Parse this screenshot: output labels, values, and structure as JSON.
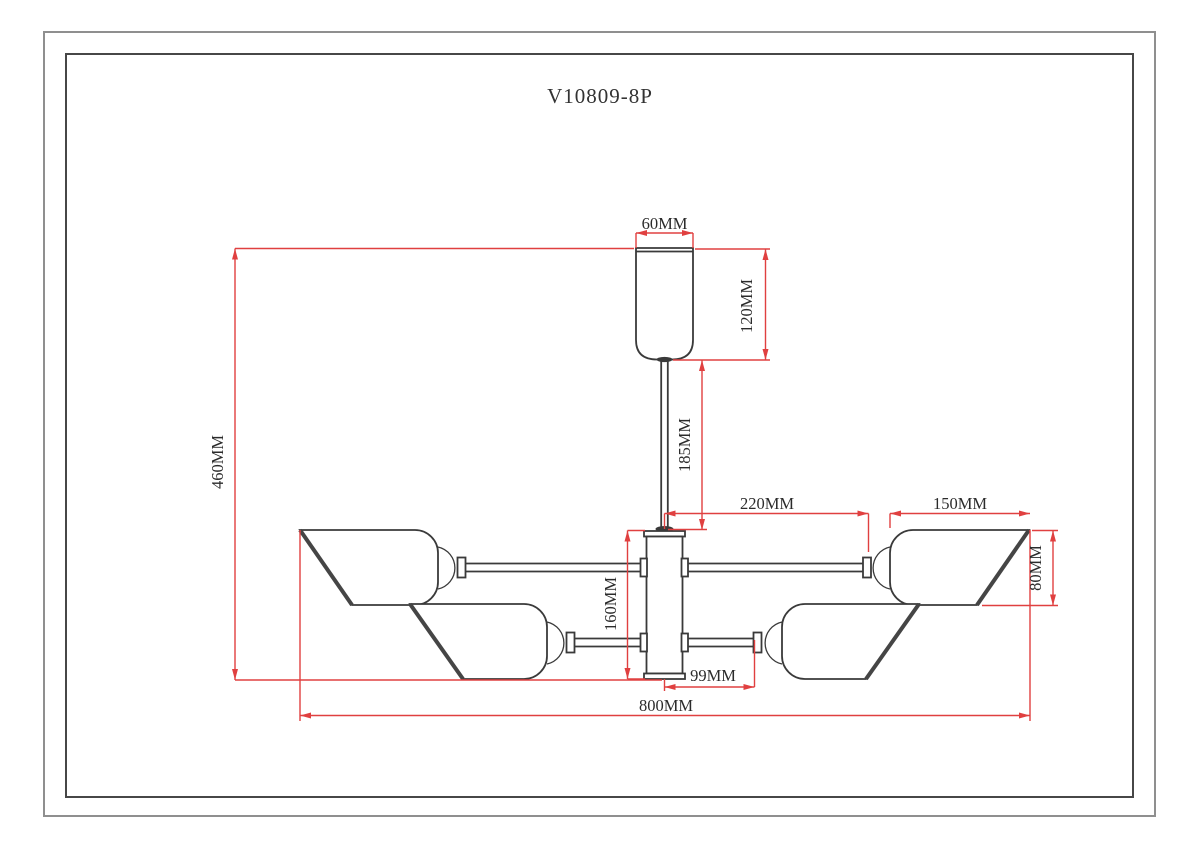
{
  "title": "V10809-8P",
  "colors": {
    "dimension_red": "#e04040",
    "drawing_line": "#3a3a3a",
    "label_text": "#2b2b2b",
    "border_outer": "#8f8f8f",
    "border_inner": "#474747",
    "paper": "#ffffff"
  },
  "drawing": {
    "type": "technical-dimension-drawing",
    "product_code": "V10809-8P",
    "unit": "MM",
    "dimensions": {
      "canopy_width": "60MM",
      "canopy_height": "120MM",
      "stem_length": "185MM",
      "overall_height": "460MM",
      "upper_arm_reach": "220MM",
      "shade_width": "150MM",
      "shade_height": "80MM",
      "body_height": "160MM",
      "lower_arm_reach": "99MM",
      "overall_width": "800MM"
    }
  }
}
